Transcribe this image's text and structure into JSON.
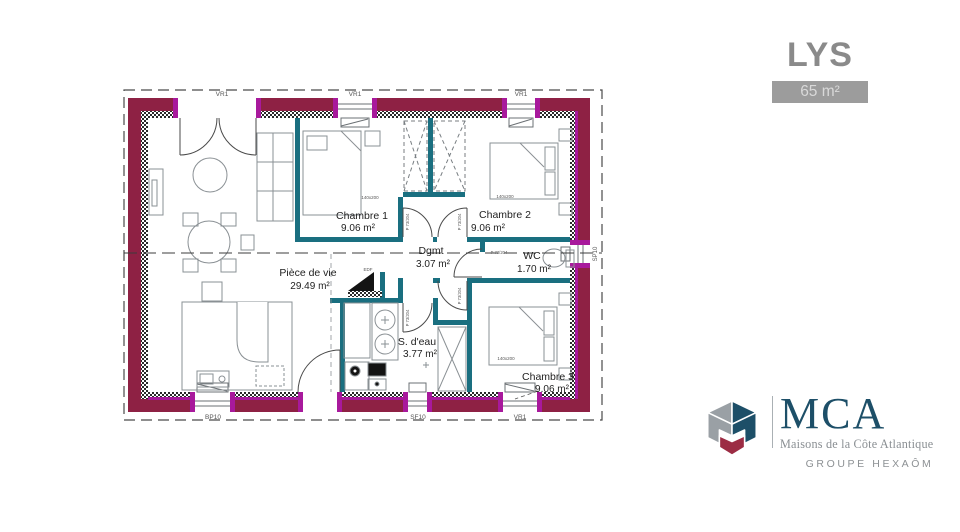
{
  "header": {
    "model_name": "LYS",
    "area_badge": "65 m²"
  },
  "plan": {
    "rooms": [
      {
        "name": "Chambre 1",
        "area": "9.06 m²"
      },
      {
        "name": "Chambre 2",
        "area": "9.06 m²"
      },
      {
        "name": "Dgmt",
        "area": "3.07 m²"
      },
      {
        "name": "WC",
        "area": "1.70 m²"
      },
      {
        "name": "Pièce de vie",
        "area": "29.49 m²"
      },
      {
        "name": "S. d'eau",
        "area": "3.77 m²"
      },
      {
        "name": "Chambre 3",
        "area": "9.06 m²"
      }
    ],
    "labels": {
      "door": "P 73/204",
      "bed_size": "140x200",
      "edf": "EDF",
      "window_top_1": "VR1",
      "window_top_2": "VR1",
      "window_top_3": "VR1",
      "window_bottom_1": "BP10",
      "window_bottom_2": "SF10",
      "window_bottom_3": "VR1",
      "window_right": "SP10"
    },
    "colors": {
      "exterior_wall": "#8E2144",
      "window_jamb": "#A8199C",
      "interior_wall": "#1A6F80",
      "furniture": "#8A9094"
    }
  },
  "logo": {
    "acronym": "MCA",
    "tagline": "Maisons de la Côte Atlantique",
    "group": "GROUPE HEXAÔM",
    "colors": {
      "blue": "#1D4F68",
      "red": "#9C2C44",
      "gray": "#9AA0A5"
    }
  }
}
